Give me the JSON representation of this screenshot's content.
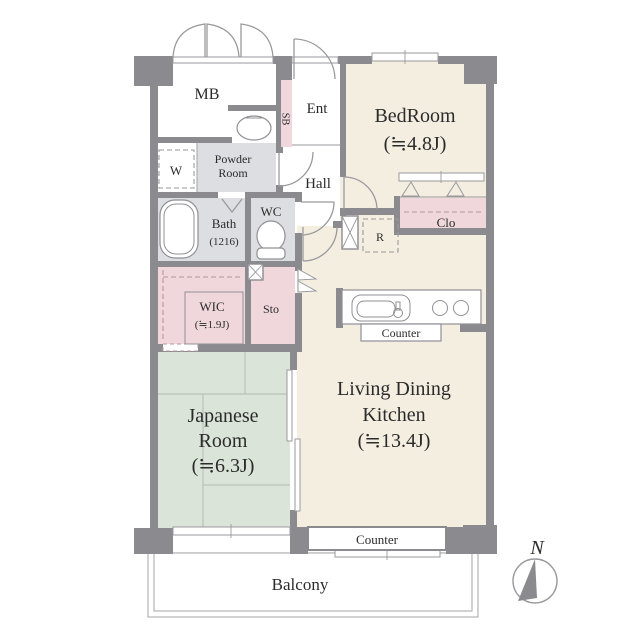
{
  "rooms": {
    "mb": {
      "label": "MB"
    },
    "ent": {
      "label": "Ent"
    },
    "sb": {
      "label": "SB"
    },
    "bedroom": {
      "name": "BedRoom",
      "size": "(≒4.8J)"
    },
    "powder_room": {
      "line1": "Powder",
      "line2": "Room"
    },
    "washer": {
      "label": "W"
    },
    "hall": {
      "label": "Hall"
    },
    "bath": {
      "name": "Bath",
      "size": "(1216)"
    },
    "wc": {
      "label": "WC"
    },
    "wic": {
      "name": "WIC",
      "size": "(≒1.9J)"
    },
    "sto": {
      "label": "Sto"
    },
    "fridge": {
      "label": "R"
    },
    "closet": {
      "label": "Clo"
    },
    "ldk": {
      "line1": "Living Dining",
      "line2": "Kitchen",
      "size": "(≒13.4J)"
    },
    "japanese_room": {
      "line1": "Japanese",
      "line2": "Room",
      "size": "(≒6.3J)"
    },
    "kitchen_counter": {
      "label": "Counter"
    },
    "window_counter": {
      "label": "Counter"
    },
    "balcony": {
      "label": "Balcony"
    }
  },
  "compass": {
    "label": "N"
  },
  "colors": {
    "wall": "#8b8b8f",
    "room_beige": "#f4eee1",
    "room_pink": "#f0d7db",
    "room_green": "#dae4d8",
    "room_gray": "#dcdee2",
    "outline": "#9a9a9e"
  }
}
